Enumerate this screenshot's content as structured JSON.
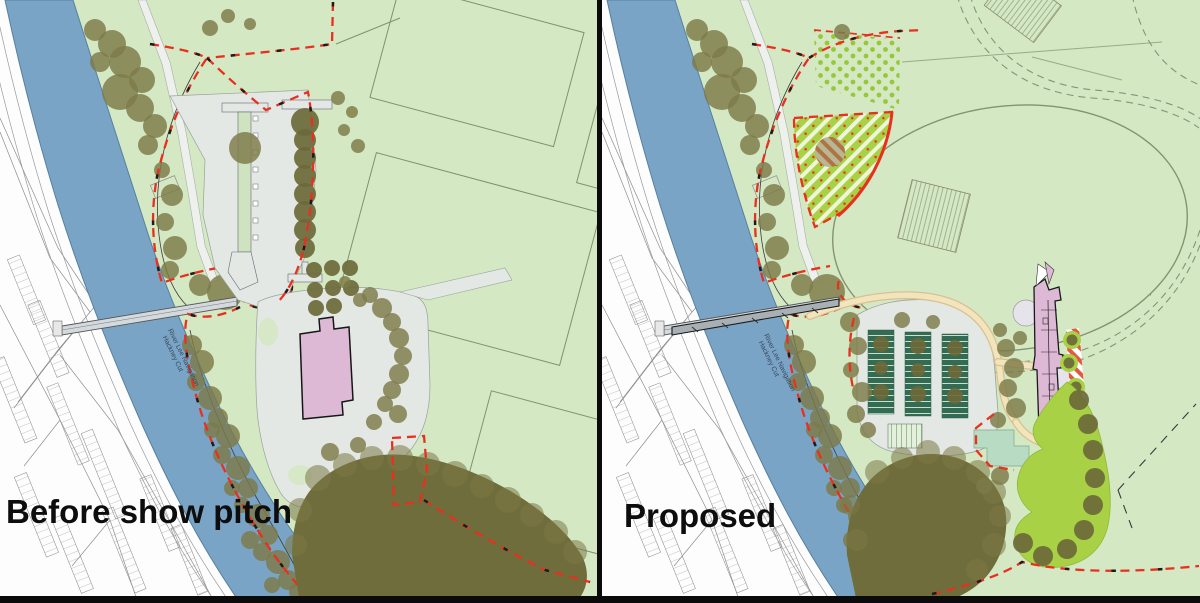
{
  "comparison": {
    "left_panel": {
      "caption": "Before show pitch"
    },
    "right_panel": {
      "caption": "Proposed"
    }
  },
  "map_labels": {
    "river_name_line1": "River Lee Navigation",
    "river_name_line2": "Hackney Cut"
  },
  "palette": {
    "park": "#d5e8c4",
    "river": "#7aa4c6",
    "riverEdge": "#56809f",
    "tree": "#7d7a48",
    "treeDark": "#6b6939",
    "woodland": "#6f6d3c",
    "red": "#e8301f",
    "pink": "#ddb9d6",
    "paving": "#e3e8e4",
    "lime": "#a9d145",
    "limeDot": "#96c838",
    "cream": "#f2e4bd",
    "creamEdge": "#d9c18f",
    "bays": "#336b53",
    "pitchLine": "#7e926f",
    "divider": "#0b0b0b"
  }
}
